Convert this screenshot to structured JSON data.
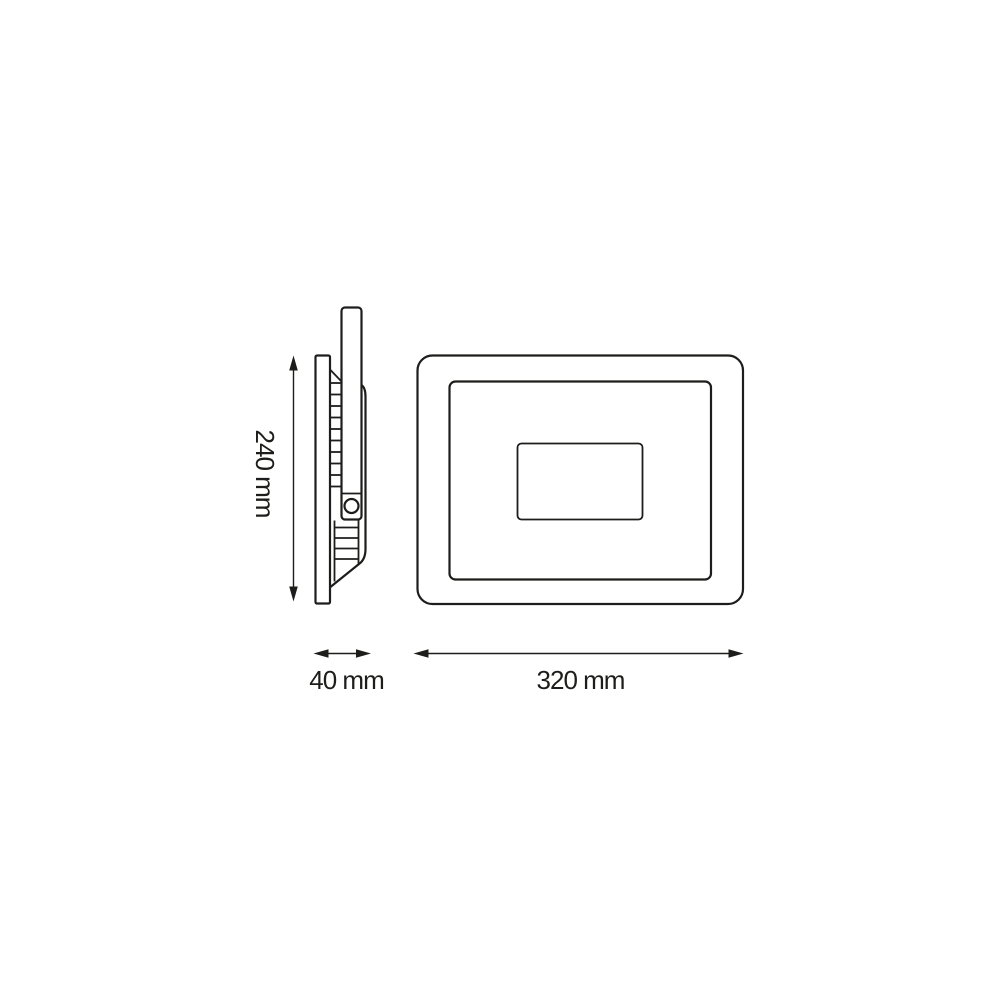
{
  "diagram": {
    "description": "Technical dimension drawing of a slim LED floodlight: side profile view on the left, front view on the right",
    "colors": {
      "line": "#1d1d1b",
      "background": "#ffffff"
    },
    "dimensions": {
      "height": {
        "label": "240 mm",
        "value": 240,
        "unit": "mm",
        "orientation": "vertical"
      },
      "depth": {
        "label": "40 mm",
        "value": 40,
        "unit": "mm",
        "orientation": "horizontal"
      },
      "width": {
        "label": "320 mm",
        "value": 320,
        "unit": "mm",
        "orientation": "horizontal"
      }
    }
  }
}
